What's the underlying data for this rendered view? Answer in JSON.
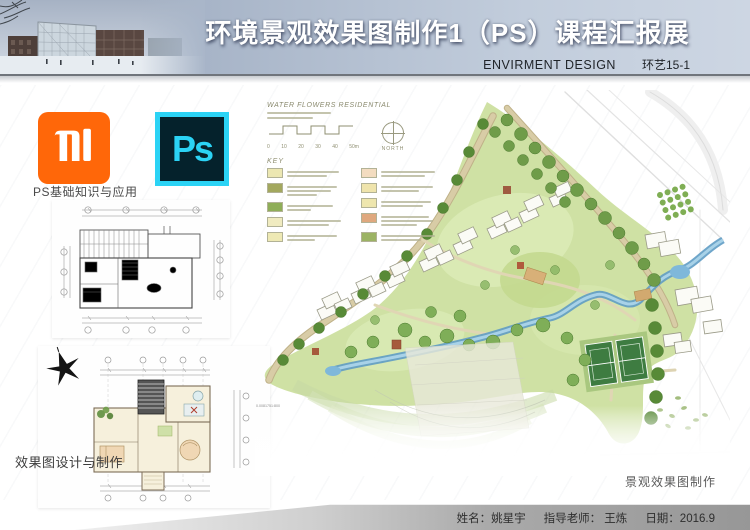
{
  "header": {
    "title": "环境景观效果图制作1（PS）课程汇报展",
    "subtitle_en": "ENVIRMENT DESIGN",
    "class_label": "环艺15-1"
  },
  "logos": {
    "ps_text": "Ps"
  },
  "labels": {
    "ps_basics": "PS基础知识与应用",
    "rendering_design": "效果图设计与制作"
  },
  "plan": {
    "caption": "景观效果图制作",
    "scale_note": "0.0081751:800",
    "legend": {
      "title": "WATER FLOWERS RESIDENTIAL",
      "key_label": "KEY",
      "north_label": "NORTH",
      "scale_ticks": [
        "0",
        "10",
        "20",
        "30",
        "40",
        "50m"
      ],
      "left_swatches": [
        "#ece7b2",
        "#a3a85e",
        "#8fae58",
        "#f0ebc0",
        "#eee9b4"
      ],
      "right_swatches": [
        "#f3dcc0",
        "#efe4ac",
        "#eee6ae",
        "#dfa87e",
        "#9cb364"
      ]
    }
  },
  "footer": {
    "name": "姓名：姚星宇",
    "teacher": "指导老师：  王炼",
    "date": "日期：2016.9"
  },
  "colors": {
    "mi_orange": "#ff6709",
    "ps_cyan": "#2bd3f5",
    "ps_dark": "#05222c"
  }
}
